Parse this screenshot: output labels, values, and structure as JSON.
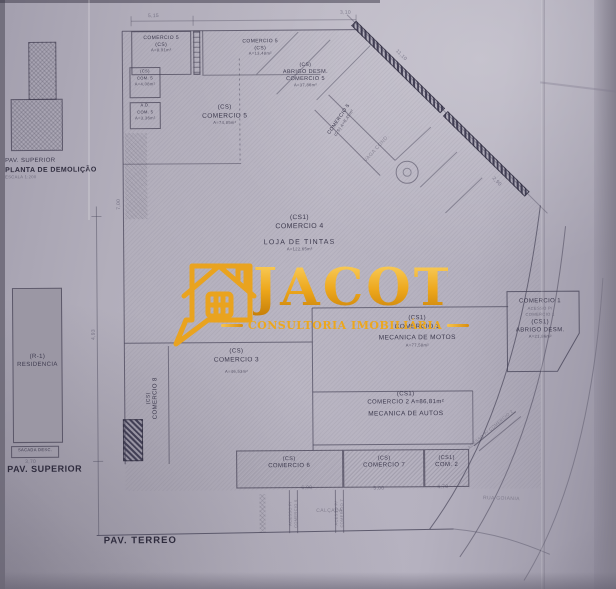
{
  "watermark": {
    "brand": "JACOT",
    "tagline": "CONSULTORIA IMOBILIÁRIA"
  },
  "captions": {
    "mini_pav": "PAV. SUPERIOR",
    "mini_title": "PLANTA DE DEMOLIÇÃO",
    "mini_scale": "ESCALA 1:200",
    "left_pav": "PAV. SUPERIOR",
    "ground": "PAV. TERREO",
    "sidewalk": "CALÇADA",
    "street": "RUA GOIANIA"
  },
  "rooms": {
    "c5a": {
      "lines": [
        "COMERCIO 5",
        "(CS)",
        "A=8,91m²"
      ]
    },
    "c5b": {
      "lines": [
        "COMERCIO 5",
        "(CS)",
        "A=13,48m²"
      ]
    },
    "c5s1": {
      "lines": [
        "(CS)",
        "COM. 5",
        "A=4,08m²"
      ]
    },
    "c5s2": {
      "lines": [
        "A.D.",
        "COM. 5",
        "A=3,36m²"
      ]
    },
    "abrigo5": {
      "lines": [
        "(CS)",
        "ABRIGO DESM.",
        "COMERCIO 5",
        "A=37,86m²"
      ]
    },
    "c5c": {
      "lines": [
        "(CS)",
        "COMERCIO 5",
        "A=74,85m²"
      ]
    },
    "c5diag": {
      "lines": [
        "COMERCIO 5",
        "(CS)  A=8,45m²"
      ]
    },
    "vaga": {
      "label": "VAGA COND."
    },
    "c4": {
      "lines": [
        "(CS1)",
        "COMERCIO 4",
        "LOJA DE TINTAS",
        "A=122,65m²"
      ]
    },
    "c1motos": {
      "lines": [
        "(CS1)",
        "COMERCIO 1",
        "MECANICA DE MOTOS",
        "A=77,58m²"
      ]
    },
    "c1abrigo": {
      "lines": [
        "COMERCIO 1",
        "ACESSO P/",
        "COMERCIO 1",
        "(CS1)",
        "ABRIGO DESM.",
        "A=21,86m²"
      ]
    },
    "c3": {
      "lines": [
        "(CS)",
        "COMERCIO 3",
        "A=46,53m²"
      ]
    },
    "c8": {
      "lines": [
        "(CS)",
        "COMERCIO 8"
      ]
    },
    "c2": {
      "lines": [
        "(CS1)",
        "COMERCIO 2  A=86,81m²",
        "MECANICA DE AUTOS"
      ]
    },
    "c6": {
      "lines": [
        "(CS)",
        "COMERCIO 6"
      ]
    },
    "c7": {
      "lines": [
        "(CS)",
        "COMERCIO 7"
      ]
    },
    "com2s": {
      "lines": [
        "(CS1)",
        "COM. 2"
      ]
    },
    "residencia": {
      "lines": [
        "(R-1)",
        "RESIDENCIA"
      ]
    },
    "sacada": {
      "label": "SACADA DESC."
    }
  },
  "access": {
    "a6": "ACESSO P/ COMERCIO 6",
    "a7": "ACESSO P/ COMERCIO 7",
    "a2": "ACESSO P/ COMERCIO 2"
  },
  "dims": {
    "top_left": "5,15",
    "top_right": "3,10",
    "diag_a": "11,10",
    "diag_b": "2,50",
    "diag_c": "2,90",
    "left_a": "7,00",
    "left_b": "4,93",
    "sacada": "3,70",
    "walk_a": "6,90",
    "walk_b": "5,00",
    "walk_c": "4,70"
  },
  "colors": {
    "paper": "#b6b2bf",
    "ink": "#3e3b4d",
    "gold": "#E9A31F",
    "residencia_fill": "#9b97a4"
  }
}
